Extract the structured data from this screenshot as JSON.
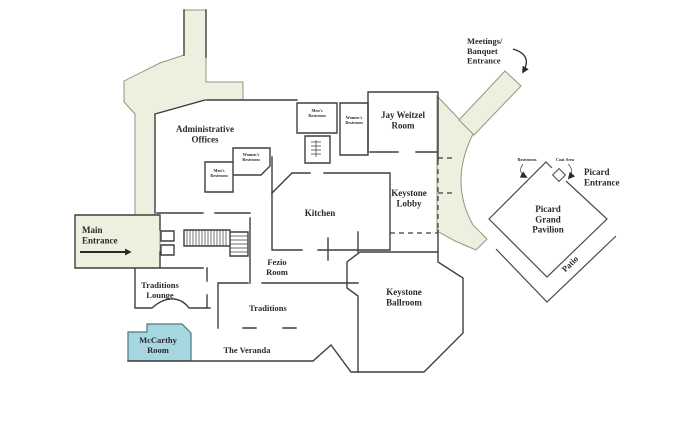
{
  "colors": {
    "background": "#ffffff",
    "wall": "#3f3f3f",
    "walkway_fill": "#edefdf",
    "walkway_stroke": "#94967f",
    "highlight_fill": "#a6d7e0",
    "highlight_stroke": "#51767c",
    "text": "#2b2a26"
  },
  "rooms": {
    "administrative_offices": [
      "Administrative",
      "Offices"
    ],
    "jay_weitzel": [
      "Jay Weitzel",
      "Room"
    ],
    "mens_restroom_north": [
      "Men's",
      "Restroom"
    ],
    "womens_restroom_north": [
      "Women's",
      "Restroom"
    ],
    "womens_restroom_west": [
      "Women's",
      "Restroom"
    ],
    "mens_restroom_west": [
      "Men's",
      "Restroom"
    ],
    "kitchen": "Kitchen",
    "keystone_lobby": [
      "Keystone",
      "Lobby"
    ],
    "keystone_ballroom": [
      "Keystone",
      "Ballroom"
    ],
    "fezio_room": [
      "Fezio",
      "Room"
    ],
    "traditions": "Traditions",
    "traditions_lounge": [
      "Traditions",
      "Lounge"
    ],
    "mccarthy_room": [
      "McCarthy",
      "Room"
    ],
    "the_veranda": "The Veranda",
    "picard_grand_pavilion": [
      "Picard",
      "Grand",
      "Pavilion"
    ],
    "patio": "Patio",
    "restrooms_note": "Restrooms",
    "coat_area_note": "Coat Area"
  },
  "entrances": {
    "main": [
      "Main",
      "Entrance"
    ],
    "meetings_banquet": [
      "Meetings/",
      "Banquet",
      "Entrance"
    ],
    "picard": [
      "Picard",
      "Entrance"
    ]
  }
}
